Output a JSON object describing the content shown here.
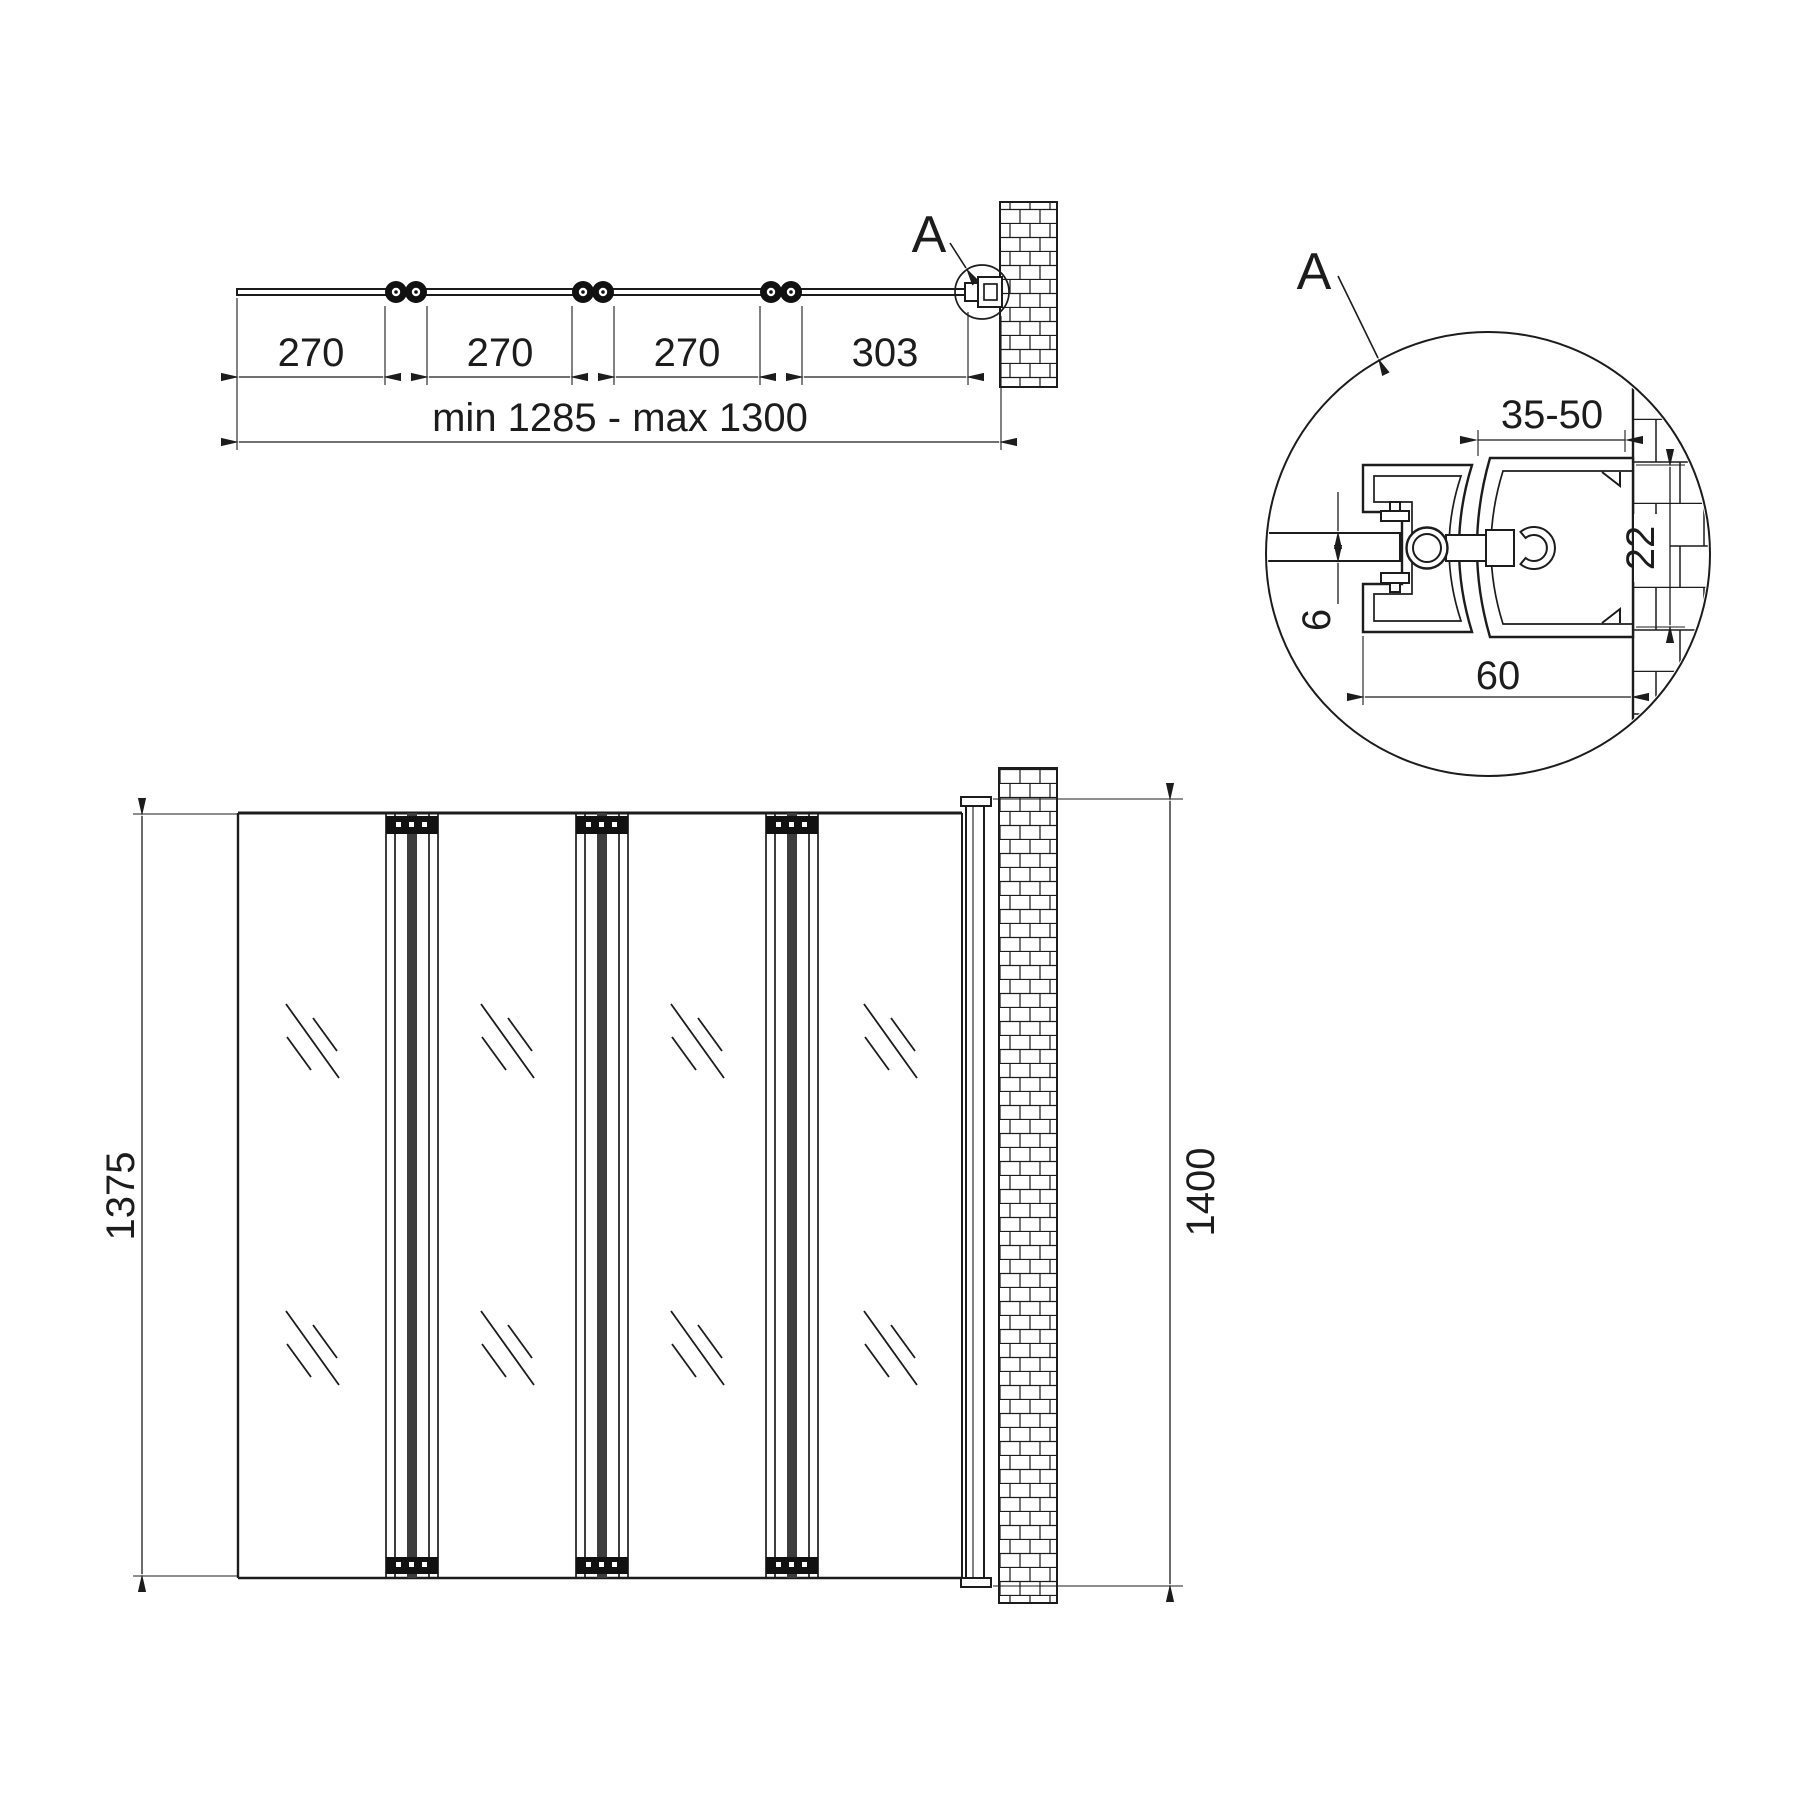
{
  "top_view": {
    "dim_section_1": "270",
    "dim_section_2": "270",
    "dim_section_3": "270",
    "dim_section_4": "303",
    "dim_overall": "min 1285 - max 1300",
    "detail_marker": "A"
  },
  "front_view": {
    "dim_height_panels": "1375",
    "dim_height_wall_profile": "1400"
  },
  "detail_view": {
    "title": "A",
    "dim_wall_profile_adjustment": "35-50",
    "dim_profile_depth": "22",
    "dim_glass_thickness": "6",
    "dim_profile_width": "60"
  },
  "colors": {
    "line": "#1c1c1c",
    "background": "#ffffff"
  }
}
